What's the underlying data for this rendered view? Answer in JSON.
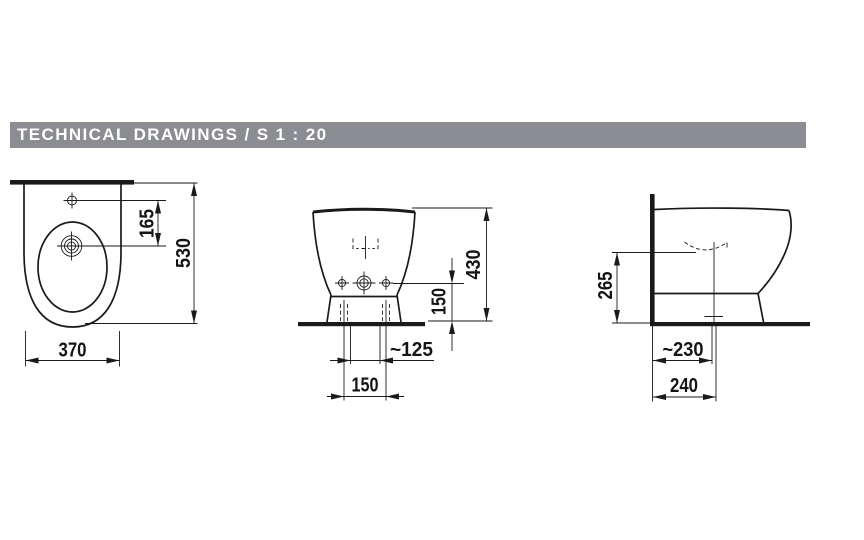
{
  "header": {
    "title": "TECHNICAL DRAWINGS / S 1 : 20",
    "section": "TECHNICAL DRAWINGS",
    "scale": "S 1 : 20"
  },
  "colors": {
    "header_bg": "#8B8D92",
    "header_text": "#FFFFFF",
    "line": "#1A1A1A",
    "page_bg": "#FFFFFF"
  },
  "views": {
    "top": {
      "label": "bidet top view",
      "dims": {
        "hole_offset": "165",
        "depth": "530",
        "width": "370"
      }
    },
    "front": {
      "label": "bidet front view",
      "dims": {
        "height": "430",
        "fixing_height": "150",
        "side_fixing": "~125",
        "fixing_spacing": "150"
      }
    },
    "side": {
      "label": "bidet side view",
      "dims": {
        "water_level_height": "265",
        "outlet_from_wall": "~230",
        "base_depth": "240"
      }
    }
  }
}
